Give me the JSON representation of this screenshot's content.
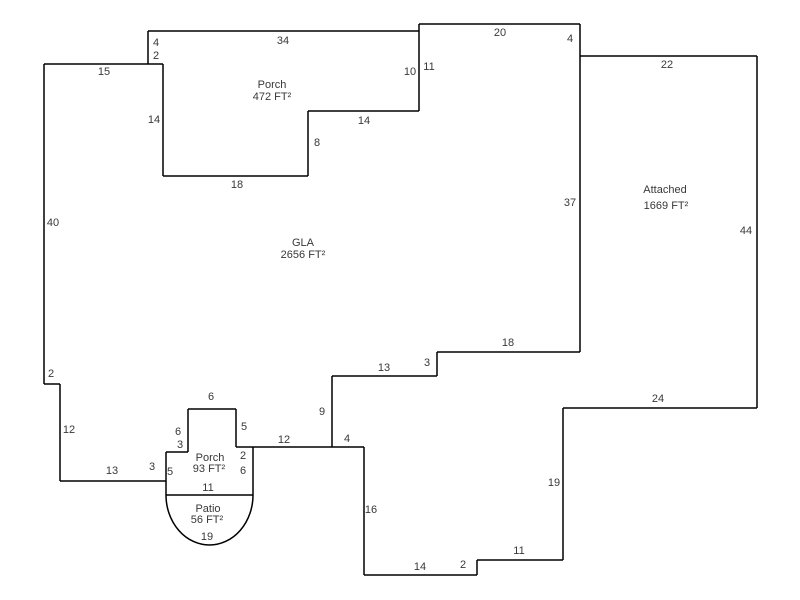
{
  "sketch": {
    "title": "floor-plan-sketch",
    "background": "#ffffff",
    "stroke_color": "#000000",
    "text_color": "#383838",
    "areas": [
      {
        "name": "Porch",
        "area": "472 FT²",
        "name_pos": [
          272,
          85
        ],
        "area_pos": [
          272,
          97
        ]
      },
      {
        "name": "GLA",
        "area": "2656 FT²",
        "name_pos": [
          303,
          243
        ],
        "area_pos": [
          303,
          255
        ]
      },
      {
        "name": "Attached",
        "area": "1669 FT²",
        "name_pos": [
          665,
          190
        ],
        "area_pos": [
          666,
          206
        ]
      },
      {
        "name": "Porch",
        "area": "93 FT²",
        "name_pos": [
          210,
          458
        ],
        "area_pos": [
          209,
          469
        ]
      },
      {
        "name": "Patio",
        "area": "56 FT²",
        "name_pos": [
          208,
          509
        ],
        "area_pos": [
          207,
          520
        ]
      }
    ],
    "dimensions": [
      {
        "t": "34",
        "x": 283,
        "y": 41
      },
      {
        "t": "4",
        "x": 156,
        "y": 43
      },
      {
        "t": "2",
        "x": 156,
        "y": 56
      },
      {
        "t": "15",
        "x": 104,
        "y": 72
      },
      {
        "t": "14",
        "x": 154,
        "y": 120
      },
      {
        "t": "18",
        "x": 237,
        "y": 185
      },
      {
        "t": "8",
        "x": 317,
        "y": 143
      },
      {
        "t": "14",
        "x": 364,
        "y": 121
      },
      {
        "t": "10",
        "x": 410,
        "y": 72
      },
      {
        "t": "11",
        "x": 429,
        "y": 67
      },
      {
        "t": "20",
        "x": 500,
        "y": 33
      },
      {
        "t": "4",
        "x": 570,
        "y": 39
      },
      {
        "t": "22",
        "x": 667,
        "y": 65
      },
      {
        "t": "44",
        "x": 746,
        "y": 231
      },
      {
        "t": "37",
        "x": 570,
        "y": 203
      },
      {
        "t": "40",
        "x": 53,
        "y": 223
      },
      {
        "t": "2",
        "x": 51,
        "y": 374
      },
      {
        "t": "12",
        "x": 69,
        "y": 430
      },
      {
        "t": "13",
        "x": 112,
        "y": 471
      },
      {
        "t": "3",
        "x": 152,
        "y": 467
      },
      {
        "t": "5",
        "x": 170,
        "y": 472
      },
      {
        "t": "3",
        "x": 180,
        "y": 445
      },
      {
        "t": "6",
        "x": 178,
        "y": 432
      },
      {
        "t": "6",
        "x": 211,
        "y": 397
      },
      {
        "t": "5",
        "x": 244,
        "y": 427
      },
      {
        "t": "2",
        "x": 243,
        "y": 456
      },
      {
        "t": "6",
        "x": 243,
        "y": 471
      },
      {
        "t": "11",
        "x": 208,
        "y": 488
      },
      {
        "t": "12",
        "x": 284,
        "y": 440
      },
      {
        "t": "9",
        "x": 322,
        "y": 412
      },
      {
        "t": "13",
        "x": 384,
        "y": 368
      },
      {
        "t": "3",
        "x": 427,
        "y": 363
      },
      {
        "t": "18",
        "x": 508,
        "y": 343
      },
      {
        "t": "4",
        "x": 347,
        "y": 439
      },
      {
        "t": "16",
        "x": 371,
        "y": 510
      },
      {
        "t": "14",
        "x": 420,
        "y": 567
      },
      {
        "t": "2",
        "x": 463,
        "y": 565
      },
      {
        "t": "11",
        "x": 519,
        "y": 551
      },
      {
        "t": "19",
        "x": 554,
        "y": 483
      },
      {
        "t": "24",
        "x": 658,
        "y": 399
      },
      {
        "t": "19",
        "x": 207,
        "y": 537
      }
    ],
    "segments": [
      [
        148,
        31,
        419,
        31
      ],
      [
        148,
        31,
        148,
        64
      ],
      [
        44,
        64,
        163,
        64
      ],
      [
        163,
        64,
        163,
        176
      ],
      [
        163,
        176,
        308,
        176
      ],
      [
        308,
        111,
        308,
        176
      ],
      [
        308,
        111,
        419,
        111
      ],
      [
        419,
        24,
        419,
        111
      ],
      [
        419,
        24,
        580,
        24
      ],
      [
        580,
        24,
        580,
        352
      ],
      [
        580,
        56,
        757,
        56
      ],
      [
        757,
        56,
        757,
        408
      ],
      [
        563,
        408,
        757,
        408
      ],
      [
        563,
        408,
        563,
        560
      ],
      [
        477,
        560,
        563,
        560
      ],
      [
        477,
        560,
        477,
        575
      ],
      [
        364,
        575,
        477,
        575
      ],
      [
        364,
        447,
        364,
        575
      ],
      [
        236,
        447,
        364,
        447
      ],
      [
        332,
        376,
        332,
        447
      ],
      [
        332,
        376,
        437,
        376
      ],
      [
        437,
        352,
        437,
        376
      ],
      [
        437,
        352,
        580,
        352
      ],
      [
        236,
        409,
        236,
        447
      ],
      [
        188,
        409,
        236,
        409
      ],
      [
        188,
        409,
        188,
        452
      ],
      [
        166,
        452,
        188,
        452
      ],
      [
        166,
        452,
        166,
        495
      ],
      [
        253,
        447,
        253,
        495
      ],
      [
        60,
        481,
        166,
        481
      ],
      [
        60,
        384,
        60,
        481
      ],
      [
        44,
        384,
        60,
        384
      ],
      [
        44,
        64,
        44,
        384
      ],
      [
        166,
        495,
        253,
        495
      ]
    ],
    "arc": {
      "from": [
        166,
        495
      ],
      "to": [
        253,
        495
      ],
      "rx": 43.5,
      "ry": 50
    }
  }
}
